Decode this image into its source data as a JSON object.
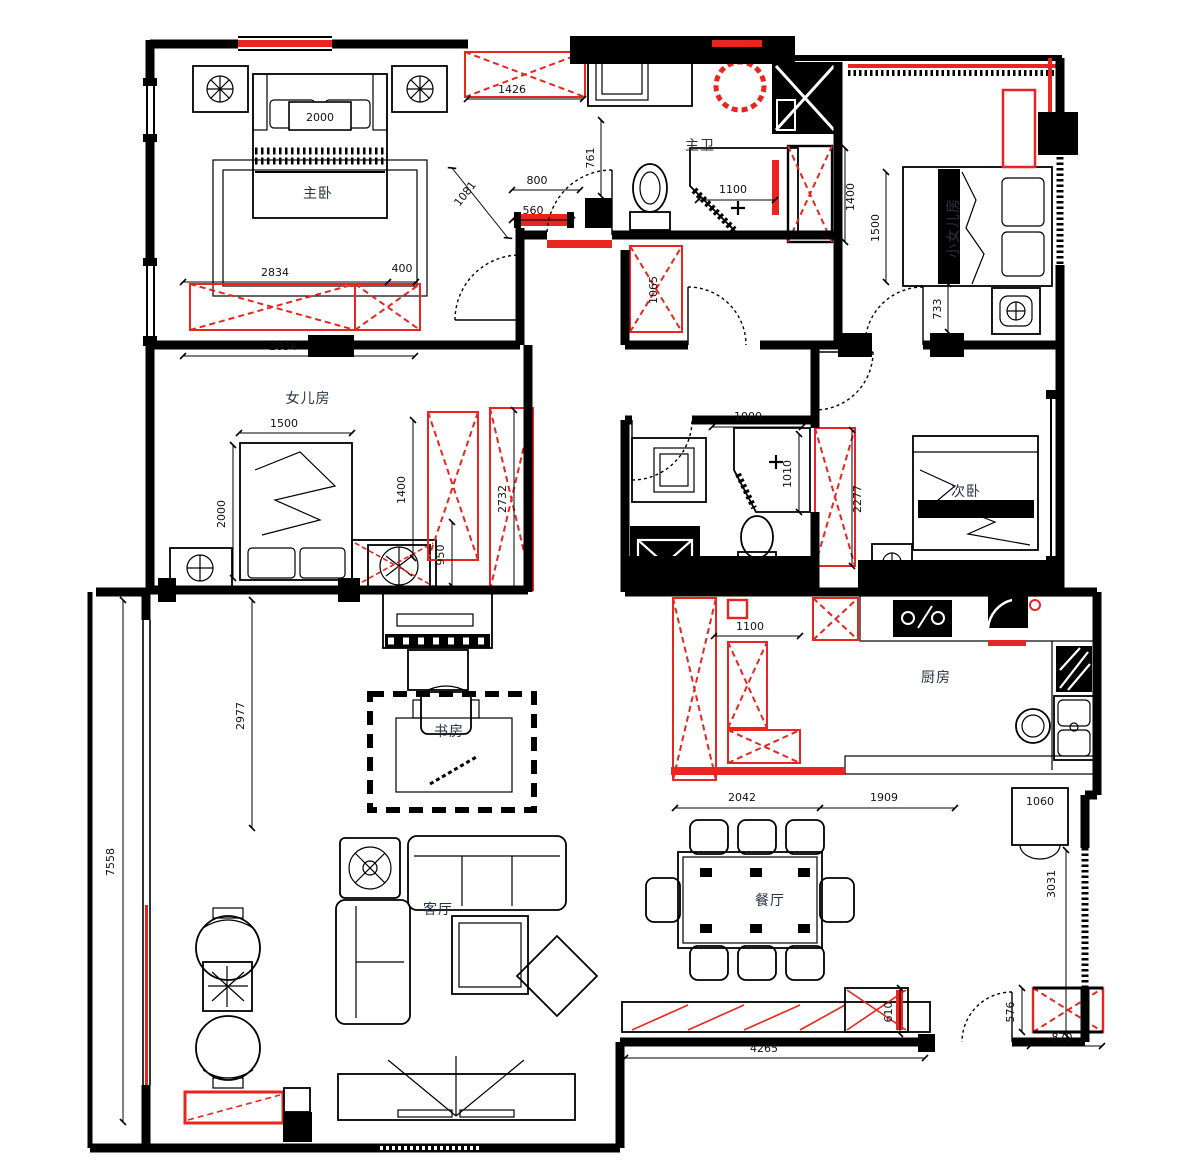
{
  "document": {
    "type": "residential-floor-plan"
  },
  "colors": {
    "wall": "#000000",
    "accent_red": "#e8251e",
    "label": "#263245",
    "dim_text": "#111111"
  },
  "rooms": {
    "master_bedroom": "主卧",
    "master_bath": "主卫",
    "young_daughter": "小女儿房",
    "daughter": "女儿房",
    "second_bedroom": "次卧",
    "study": "书房",
    "kitchen": "厨房",
    "dining": "餐厅",
    "living": "客厅"
  },
  "dims": {
    "d2000": "2000",
    "d2834a": "2834",
    "d400": "400",
    "d2834b": "2834",
    "d1426": "1426",
    "d761": "761",
    "d800": "800",
    "d560": "560",
    "d1081": "1081",
    "d1100a": "1100",
    "d1400a": "1400",
    "d1500a": "1500",
    "d733": "733",
    "d1065": "1065",
    "d1500b": "1500",
    "d2000b": "2000",
    "d1400b": "1400",
    "d950": "950",
    "d2732": "2732",
    "d1000": "1000",
    "d1010": "1010",
    "d2277": "2277",
    "d1100b": "1100",
    "d2042": "2042",
    "d1909": "1909",
    "d1060": "1060",
    "d3031": "3031",
    "d610": "610",
    "d4265": "4265",
    "d576": "576",
    "d870": "870",
    "d7558": "7558",
    "d2977": "2977"
  }
}
